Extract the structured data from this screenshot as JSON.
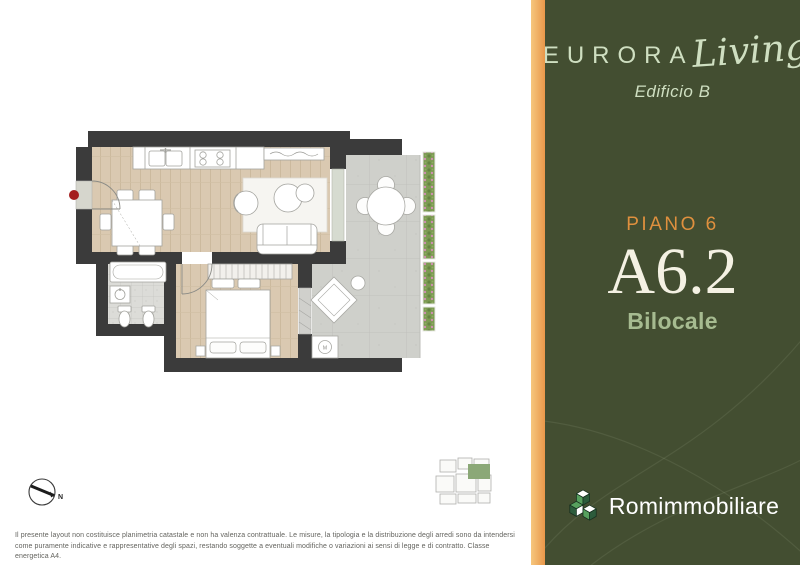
{
  "panel": {
    "brand_name": "EURORA",
    "brand_script": "Living",
    "building": "Edificio B",
    "floor_label": "PIANO 6",
    "unit_code": "A6.2",
    "unit_type": "Bilocale",
    "agency_name": "Romimmobiliare",
    "colors": {
      "panel_green": "#434e31",
      "divider_orange": "#eda253",
      "floor_label_orange": "#df903e",
      "unit_cream": "#f4f1e3",
      "type_sage": "#a6bb90",
      "brand_mint": "#cfdfc1",
      "agency_white": "#ffffff"
    }
  },
  "floorplan": {
    "washer_label": "M",
    "compass_label": "N",
    "entrance_dot_color": "#a41e1e",
    "wall_color": "#3b3b3b",
    "wood_floor_color": "#dac9b1",
    "bath_tile_color": "#dcdcd8",
    "terrace_color": "#cfd0cb",
    "plant_color": "#7c9a52",
    "keyplan_highlight": "#8ba877"
  },
  "disclaimer": {
    "line1": "Il presente layout non costituisce planimetria catastale e non ha valenza contrattuale. Le misure, la tipologia e la distribuzione degli arredi sono da intendersi",
    "line2": "come puramente indicative e rappresentative degli spazi, restando soggette a eventuali modifiche o variazioni ai sensi di legge e di contratto. Classe energetica A4."
  }
}
